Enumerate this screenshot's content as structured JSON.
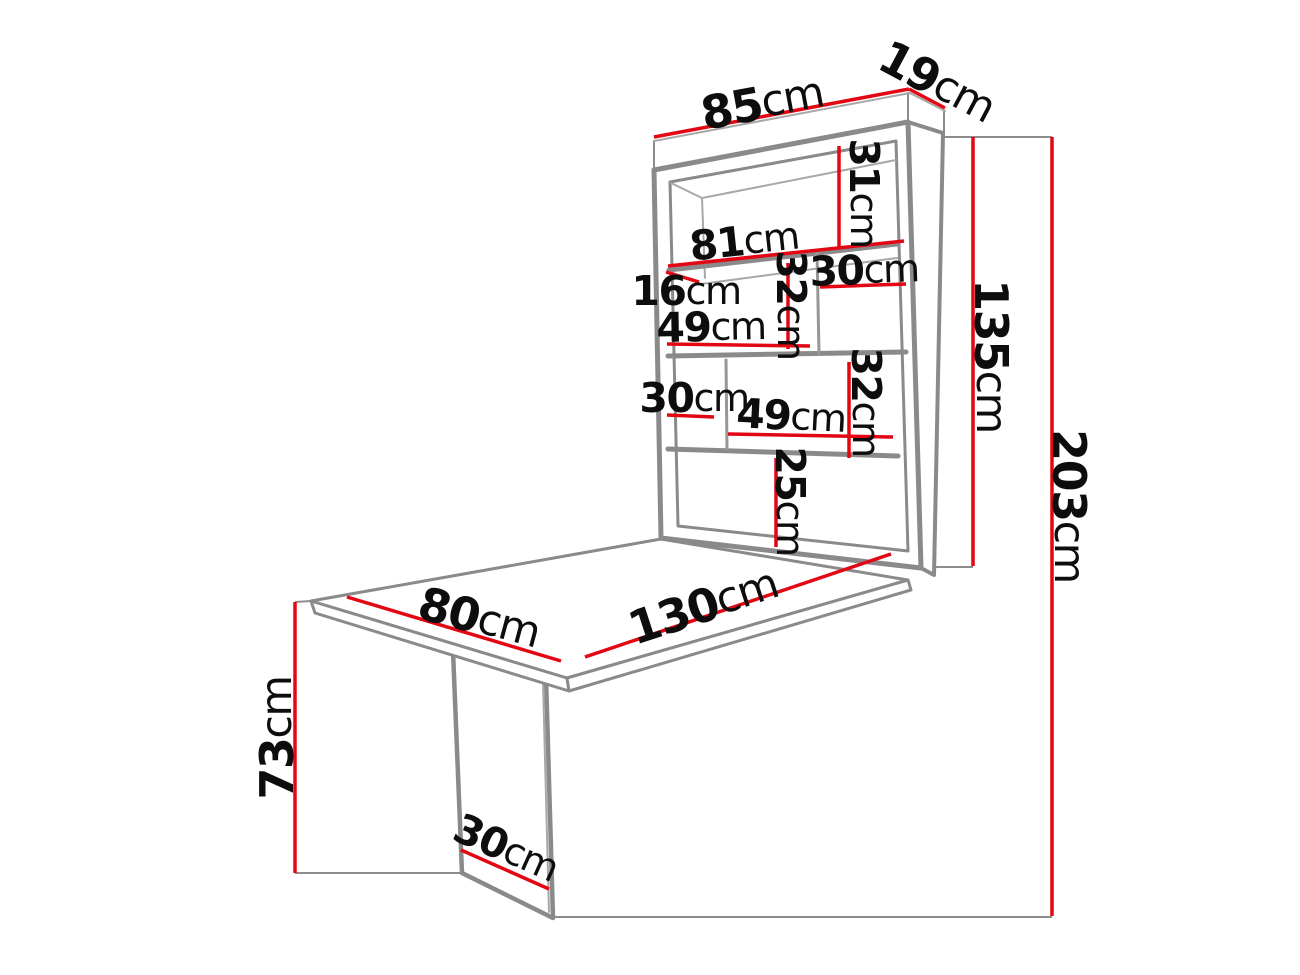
{
  "colors": {
    "background": "#ffffff",
    "dimension_red": "#e30613",
    "furniture_outline_gray": "#8a8a8a",
    "label_black": "#0d0d0d"
  },
  "diagram": {
    "unit": "cm",
    "dims": {
      "d85": {
        "value": "85",
        "unit": "cm"
      },
      "d19": {
        "value": "19",
        "unit": "cm"
      },
      "d31": {
        "value": "31",
        "unit": "cm"
      },
      "d81": {
        "value": "81",
        "unit": "cm"
      },
      "d30_top": {
        "value": "30",
        "unit": "cm"
      },
      "d16": {
        "value": "16",
        "unit": "cm"
      },
      "d49_top": {
        "value": "49",
        "unit": "cm"
      },
      "d32_top": {
        "value": "32",
        "unit": "cm"
      },
      "d30_mid": {
        "value": "30",
        "unit": "cm"
      },
      "d49_mid": {
        "value": "49",
        "unit": "cm"
      },
      "d32_right": {
        "value": "32",
        "unit": "cm"
      },
      "d25": {
        "value": "25",
        "unit": "cm"
      },
      "d135": {
        "value": "135",
        "unit": "cm"
      },
      "d203": {
        "value": "203",
        "unit": "cm"
      },
      "d73": {
        "value": "73",
        "unit": "cm"
      },
      "d80": {
        "value": "80",
        "unit": "cm"
      },
      "d130": {
        "value": "130",
        "unit": "cm"
      },
      "d30_leg": {
        "value": "30",
        "unit": "cm"
      }
    }
  }
}
